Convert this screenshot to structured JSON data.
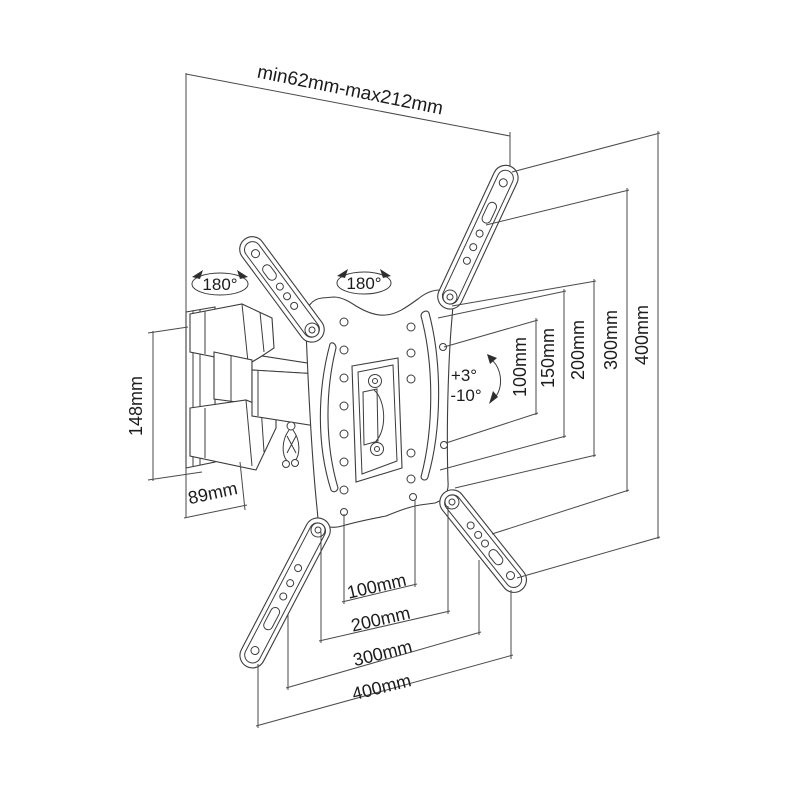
{
  "diagram_title": "Articulating TV wall mount - dimensional drawing",
  "colors": {
    "line": "#3c3c3c",
    "dimension_line": "#4a4a4a",
    "text": "#1c1c1c",
    "background": "#ffffff"
  },
  "labels": {
    "extension_range": "min62mm-max212mm",
    "swivel_left": "180°",
    "swivel_right": "180°",
    "tilt_up": "+3°",
    "tilt_down": "-10°",
    "bracket_height": "148mm",
    "bracket_depth": "89mm"
  },
  "vesa_vertical": [
    "100mm",
    "150mm",
    "200mm",
    "300mm",
    "400mm"
  ],
  "vesa_horizontal": [
    "100mm",
    "200mm",
    "300mm",
    "400mm"
  ]
}
